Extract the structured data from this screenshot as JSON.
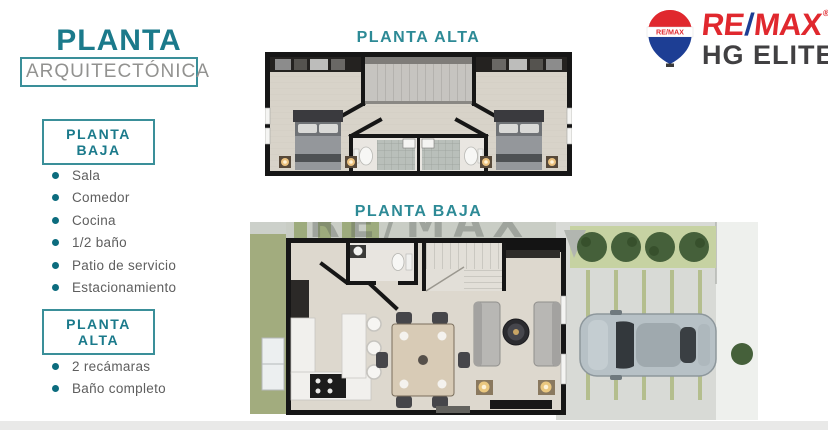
{
  "slide": {
    "background": "#ffffff",
    "bottom_bar_color": "#e9e9e8"
  },
  "palette": {
    "teal_title": "#1b7a8b",
    "teal_border": "#3a8f99",
    "bullet_teal": "#0c6c7e",
    "subtitle_gray": "#929290",
    "list_text": "#5e5e5e",
    "remax_red": "#e0282e",
    "remax_blue": "#1d3e94",
    "logo_dark": "#414042",
    "wall_black": "#161616",
    "floor_beige": "#d8d3c9",
    "grass_green": "#a9b284",
    "hedge_green": "#45603a",
    "pavement_gray": "#d8dad6",
    "car_silver": "#b7c1c6"
  },
  "sidebar": {
    "title": "PLANTA",
    "subtitle": "ARQUITECTÓNICA",
    "sections": [
      {
        "label": "PLANTA BAJA",
        "items": [
          "Sala",
          "Comedor",
          "Cocina",
          "1/2 baño",
          "Patio de servicio",
          "Estacionamiento"
        ]
      },
      {
        "label": "PLANTA ALTA",
        "items": [
          "2 recámaras",
          "Baño completo"
        ]
      }
    ]
  },
  "logo": {
    "line1_part1": "RE",
    "line1_slash": "/",
    "line1_part2": "MAX",
    "registered": "®",
    "line2": "HG ELITE",
    "balloon_label": "RE/MAX"
  },
  "plans": [
    {
      "id": "planta-alta",
      "title": "PLANTA ALTA"
    },
    {
      "id": "planta-baja",
      "title": "PLANTA BAJA"
    }
  ],
  "watermark": {
    "text": "RE/MAX"
  }
}
